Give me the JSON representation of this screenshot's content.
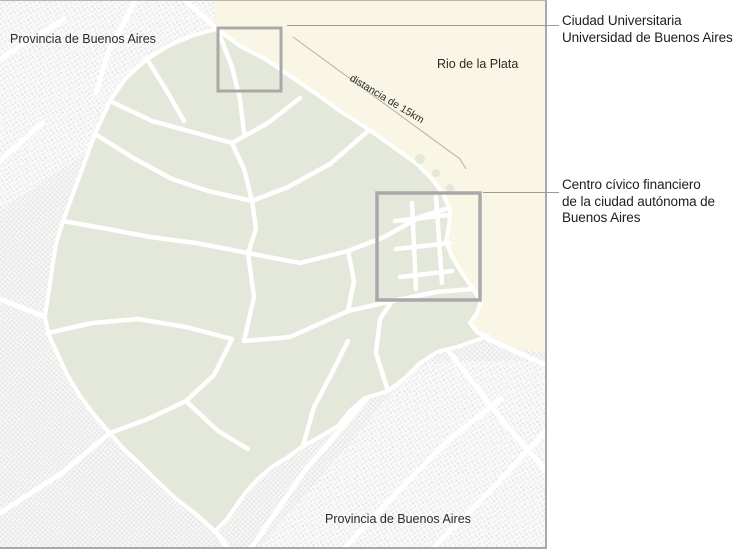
{
  "colors": {
    "map_background": "#e8e8e7",
    "city_fill": "#e3e8da",
    "water_fill": "#faf6e6",
    "street_white": "#ffffff",
    "map_border": "#a9a9a9",
    "callout_box": "#a9a9a9",
    "callout_line": "#9b9b9b",
    "annotation_text": "#1d1d1b",
    "map_label_text": "#2b2a26"
  },
  "map_labels": {
    "province_top": "Provincia de Buenos Aires",
    "river": "Rio de la Plata",
    "distance": "distancia de 15km",
    "province_bottom": "Provincia de Buenos Aires"
  },
  "annotations": {
    "ciudad_universitaria": "Ciudad Universitaria\nUniversidad de Buenos Aires",
    "centro_civico": "Centro cívico financiero\nde la ciudad autónoma de\nBuenos Aires"
  }
}
